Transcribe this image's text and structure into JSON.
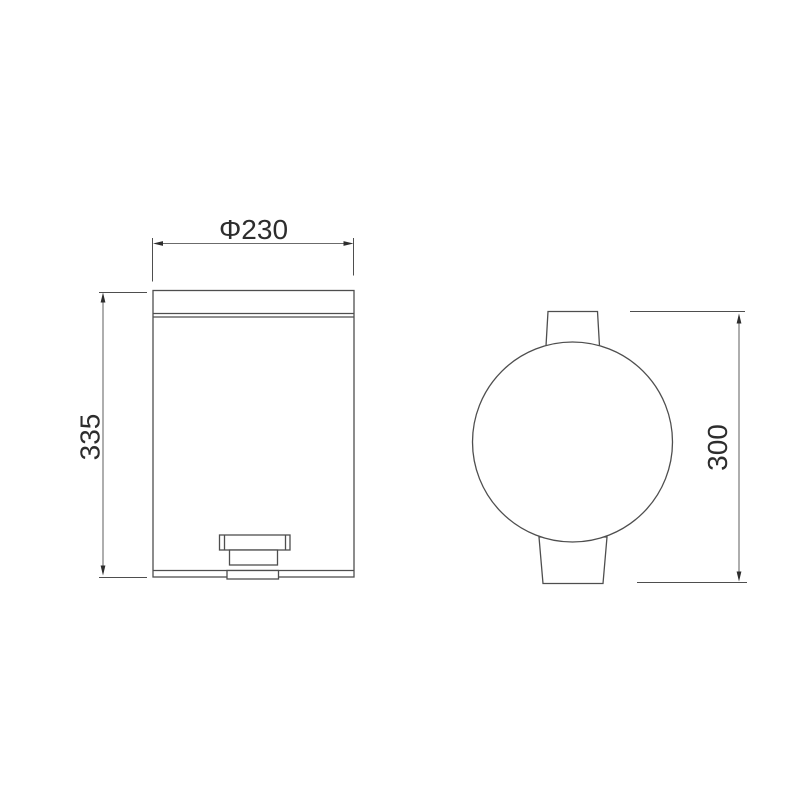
{
  "theme": {
    "background": "#ffffff",
    "fill": "#ffffff",
    "line": "#4e4e4e",
    "dimline": "#6b6b6b",
    "text": "#2d2d2d"
  },
  "drawing": {
    "kind": "technical-drawing",
    "subject": "pedal waste bin, front view and top view",
    "dimensions": {
      "diameter": {
        "label": "Φ230"
      },
      "height_front": {
        "label": "335"
      },
      "height_top": {
        "label": "300"
      }
    }
  }
}
